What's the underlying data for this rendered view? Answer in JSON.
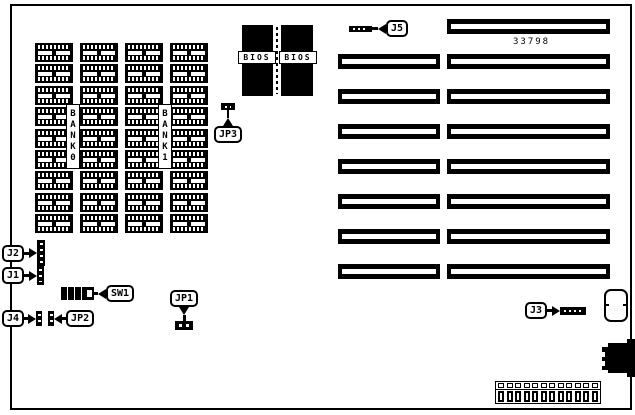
{
  "diagram": {
    "part_number": "33798",
    "banks": [
      {
        "label": "BANK0"
      },
      {
        "label": "BANK1"
      }
    ],
    "bios_chips": [
      {
        "label": "BIOS"
      },
      {
        "label": "BIOS"
      }
    ],
    "memory": {
      "rows": 9,
      "cols": 4
    },
    "slots": {
      "left_count": 7,
      "right_count": 8
    },
    "power_connector": {
      "pins": 12
    },
    "callouts": {
      "j5": {
        "label": "J5"
      },
      "jp3": {
        "label": "JP3"
      },
      "j2": {
        "label": "J2"
      },
      "j1": {
        "label": "J1"
      },
      "sw1": {
        "label": "SW1"
      },
      "j4": {
        "label": "J4"
      },
      "jp2": {
        "label": "JP2"
      },
      "jp1": {
        "label": "JP1"
      },
      "j3": {
        "label": "J3"
      }
    },
    "colors": {
      "ink": "#000000",
      "paper": "#ffffff"
    }
  }
}
